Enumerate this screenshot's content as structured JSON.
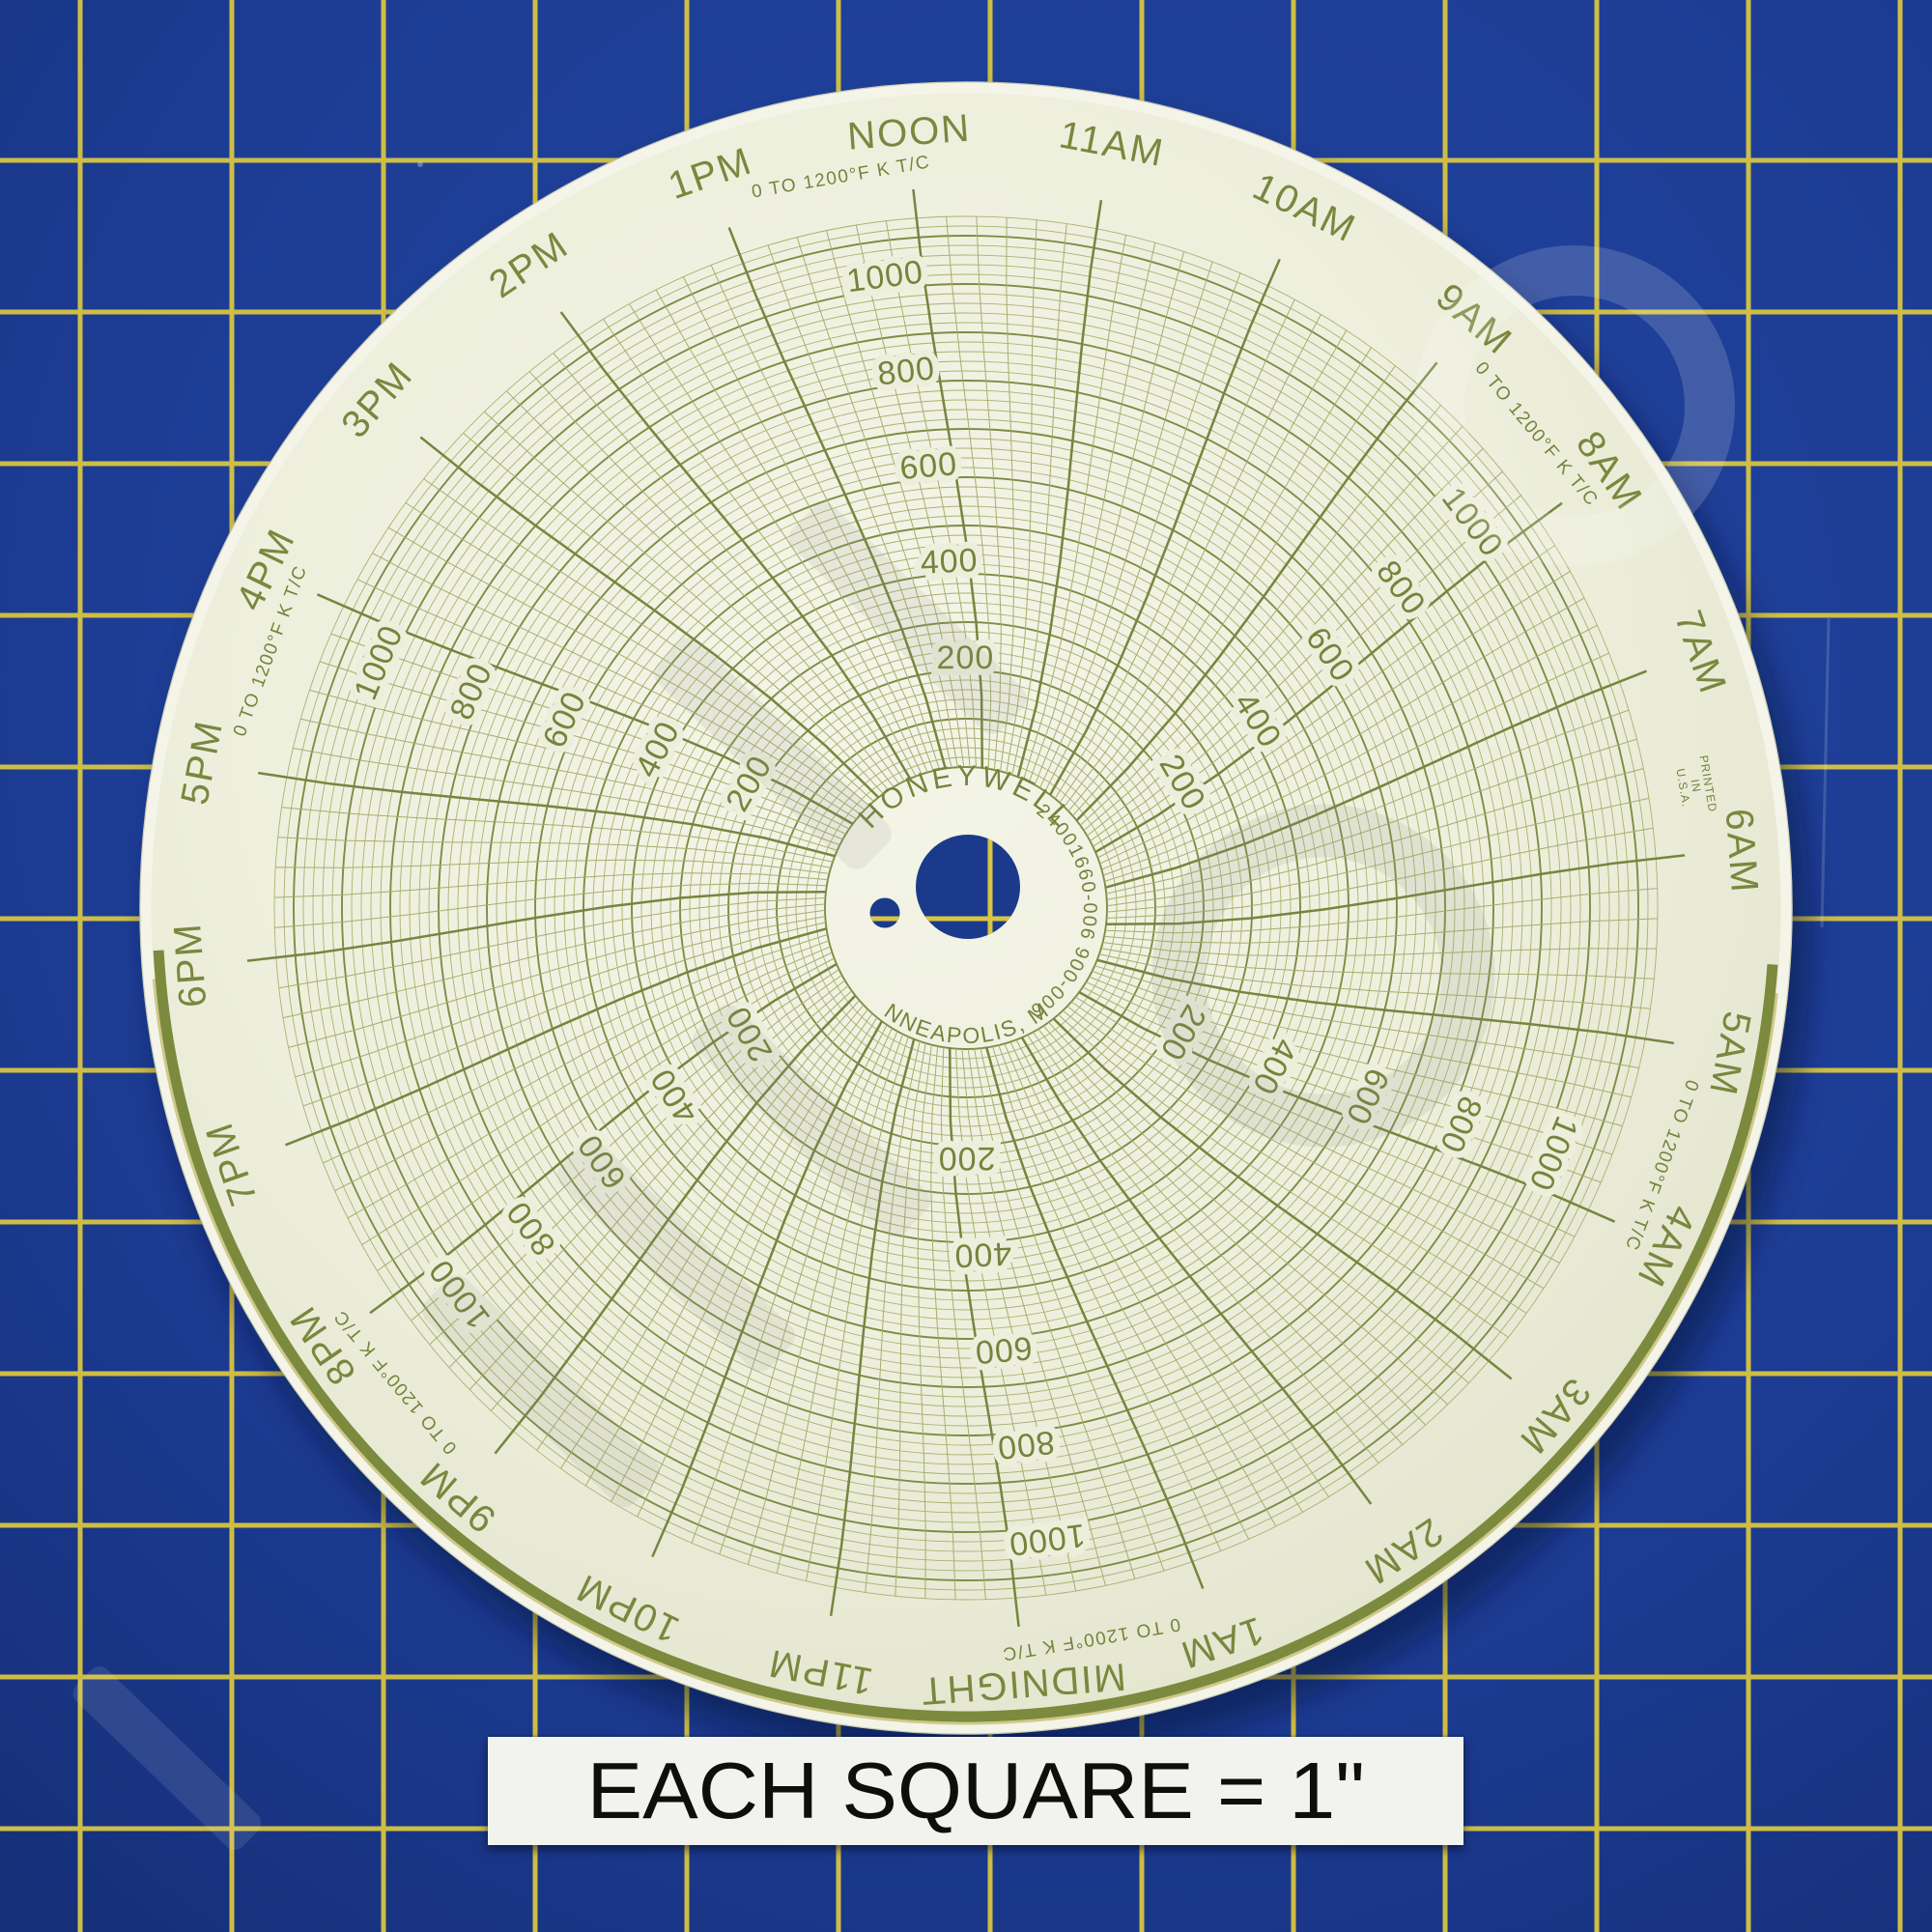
{
  "sticker": {
    "text": "EACH SQUARE = 1\""
  },
  "mat": {
    "surface_color": "#1d3d95",
    "grid_line_color": "#d8c542",
    "square_note": "1 inch squares"
  },
  "colors": {
    "paper": "#edefdc",
    "paper_light": "#f4f5e8",
    "paper_dark": "#dfe1c9",
    "grid_minor": "#a6ae6c",
    "grid_major": "#7e8c45",
    "chart_text": "#76833c",
    "rim_band": "#7b8a3d",
    "rim_band_edge": "#b7ad52",
    "hole_mat_blue": "#1b3a8c",
    "sticker_bg": "#f2f2ee",
    "sticker_text": "#0e0e0e"
  },
  "chart_data": {
    "type": "polar-grid",
    "title": "HONEYWELL",
    "subtitle": "blank 24-hour circular chart recorder paper (no recorded trace)",
    "center_text": {
      "brand": "HONEYWELL",
      "part_number": "24001660-006  900-006",
      "city": "MINNEAPOLIS, MN."
    },
    "printed_note_lines": [
      "PRINTED",
      "IN",
      "U.S.A."
    ],
    "scale_label": "0 TO 1200°F K T/C",
    "scale_label_spokes_deg": [
      0,
      60,
      120,
      180,
      240,
      300
    ],
    "value_min": 0,
    "value_max": 1200,
    "ring_minor_step": 20,
    "ring_major_step": 100,
    "value_tick_labels": [
      200,
      400,
      600,
      800,
      1000
    ],
    "value_label_spokes_deg": [
      0,
      60,
      120,
      180,
      240,
      300
    ],
    "time_labels_clockwise_from_top": [
      "NOON",
      "11AM",
      "10AM",
      "9AM",
      "8AM",
      "7AM",
      "6AM",
      "5AM",
      "4AM",
      "3AM",
      "2AM",
      "1AM",
      "MIDNIGHT",
      "11PM",
      "10PM",
      "9PM",
      "8PM",
      "7PM",
      "6PM",
      "5PM",
      "4PM",
      "3PM",
      "2PM",
      "1PM"
    ],
    "hours_per_revolution": 24,
    "degrees_per_hour": 15,
    "time_minor_step_minutes": 10,
    "rim_band_span_hours": "6AM around midnight to 6PM",
    "series": []
  }
}
